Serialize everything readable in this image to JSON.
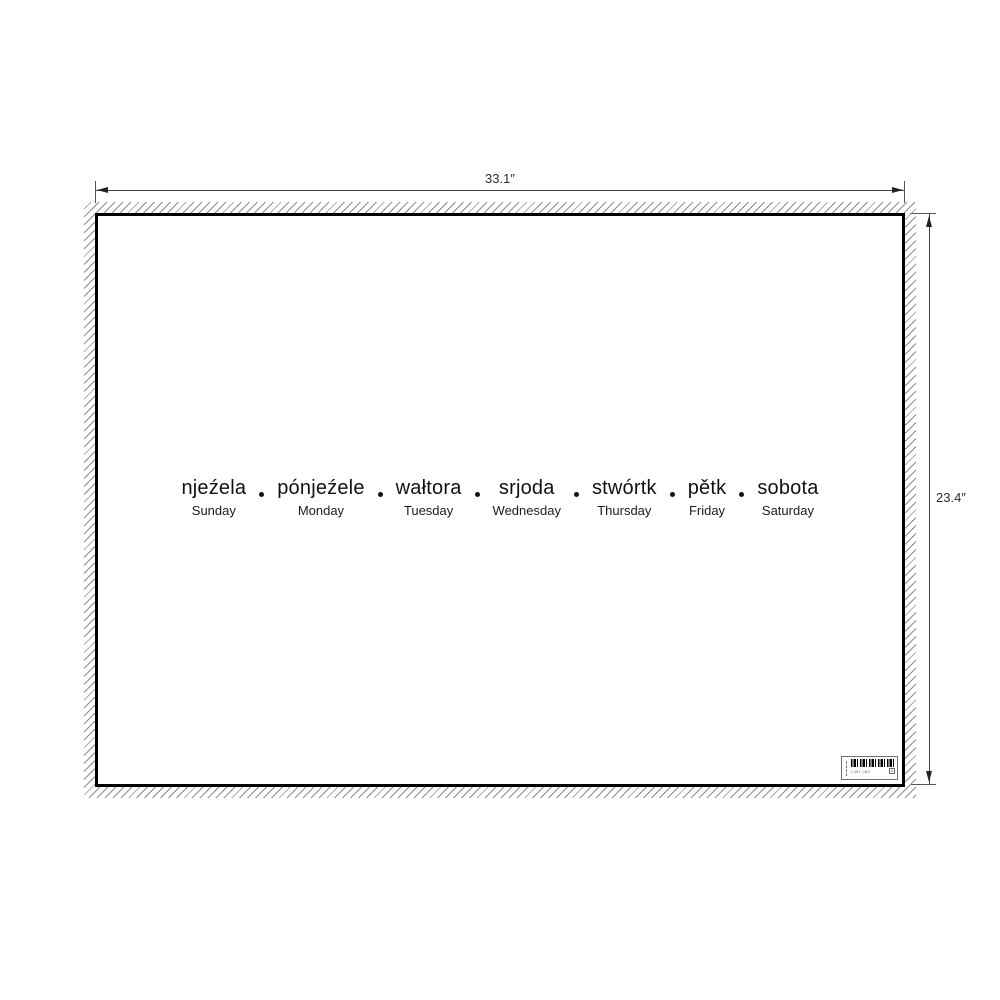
{
  "mockup": {
    "dimension_width_label": "33.1″",
    "dimension_height_label": "23.4″",
    "poster": {
      "days": [
        {
          "sorbian": "njeźela",
          "english": "Sunday"
        },
        {
          "sorbian": "pónjeźele",
          "english": "Monday"
        },
        {
          "sorbian": "wałtora",
          "english": "Tuesday"
        },
        {
          "sorbian": "srjoda",
          "english": "Wednesday"
        },
        {
          "sorbian": "stwórtk",
          "english": "Thursday"
        },
        {
          "sorbian": "pětk",
          "english": "Friday"
        },
        {
          "sorbian": "sobota",
          "english": "Saturday"
        }
      ],
      "barcode_label": {
        "code_text": "L391 083",
        "corner_mark": "A"
      }
    },
    "colors": {
      "poster_border": "#000000",
      "day_text": "#111111",
      "dimension_lines": "#3d3d3d",
      "hatch": "#8c8c8c",
      "background": "#ffffff"
    }
  }
}
